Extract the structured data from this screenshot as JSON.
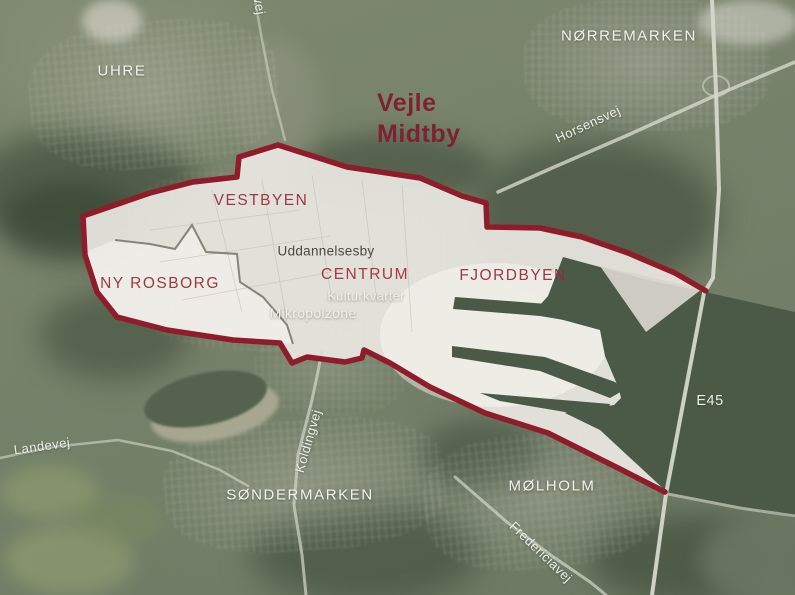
{
  "map": {
    "title": {
      "line1": "Vejle",
      "line2": "Midtby"
    },
    "districts": {
      "vestbyen": "VESTBYEN",
      "ny_rosborg": "NY ROSBORG",
      "centrum": "CENTRUM",
      "fjordbyen": "FJORDBYEN"
    },
    "neighborhoods": {
      "uhre": "UHRE",
      "norremarken": "NØRREMARKEN",
      "sondermarken": "SØNDERMARKEN",
      "molholm": "MØLHOLM"
    },
    "zones": {
      "uddannelsesby": "Uddannelsesby",
      "kulturkvarter": "Kulturkvarter",
      "mikropolzone": "Mikropolzone"
    },
    "roads": {
      "jellingvej": "Jellingvej",
      "horsensvej": "Horsensvej",
      "koldingvej": "Koldingvej",
      "fredericiavej": "Fredericiavej",
      "landevej": "Landevej",
      "e45": "E45"
    },
    "colors": {
      "boundary_red": "#8e1c2b",
      "district_label_red": "#942a39",
      "title_red": "#7d2230",
      "highlight_area": "#eae7e1",
      "water_dark": "#4b5a46",
      "terrain_green": "#77826b",
      "label_white": "#f2f3ee"
    }
  }
}
